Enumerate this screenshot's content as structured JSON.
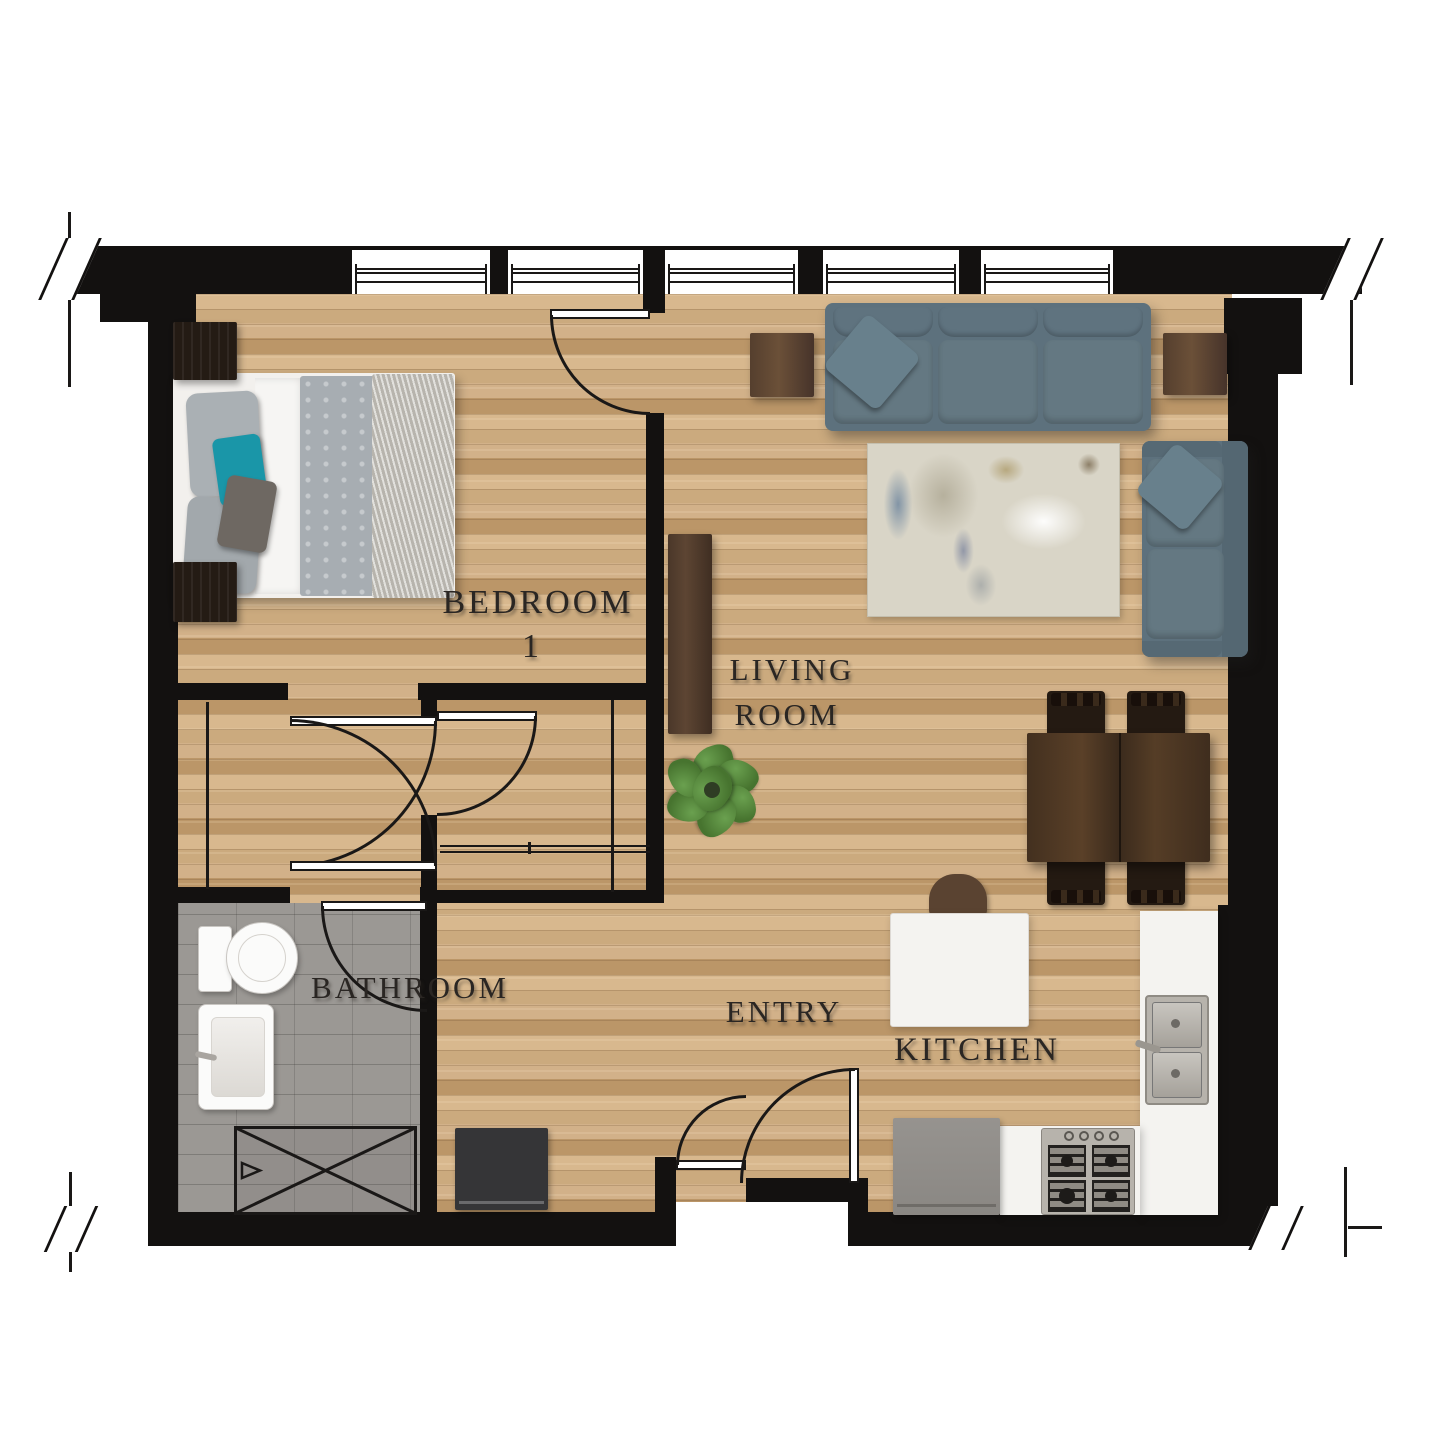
{
  "page_title": "One-bedroom apartment floor plan",
  "rooms": {
    "bedroom": {
      "name": "Bedroom 1",
      "label_line1": "BEDROOM",
      "label_line2": "1"
    },
    "living_room": {
      "name": "Living Room",
      "label_line1": "LIVING",
      "label_line2": "ROOM"
    },
    "bathroom": {
      "name": "Bathroom",
      "label": "BATHROOM"
    },
    "entry": {
      "name": "Entry",
      "label": "ENTRY"
    },
    "kitchen": {
      "name": "Kitchen",
      "label": "KITCHEN"
    }
  },
  "colors": {
    "wall": "#131110",
    "line": "#1a1817",
    "wood_base": "#cbaa7e",
    "wood_light": "#d8b88e",
    "wood_dark": "#bb9668",
    "tile": "#9b9894",
    "sofa_body": "#5d717d",
    "sofa_cushion": "#647882",
    "accent_teal": "#1a96a8",
    "table_wood": "#43301f",
    "night_wood": "#241b14",
    "counter_white": "#f4f3f0",
    "steel_gray": "#b7b3ac",
    "fridge_gray": "#93908c",
    "rug_base": "#d9d5c7",
    "plant_green": "#55823d",
    "label_ink": "#2a2623"
  }
}
